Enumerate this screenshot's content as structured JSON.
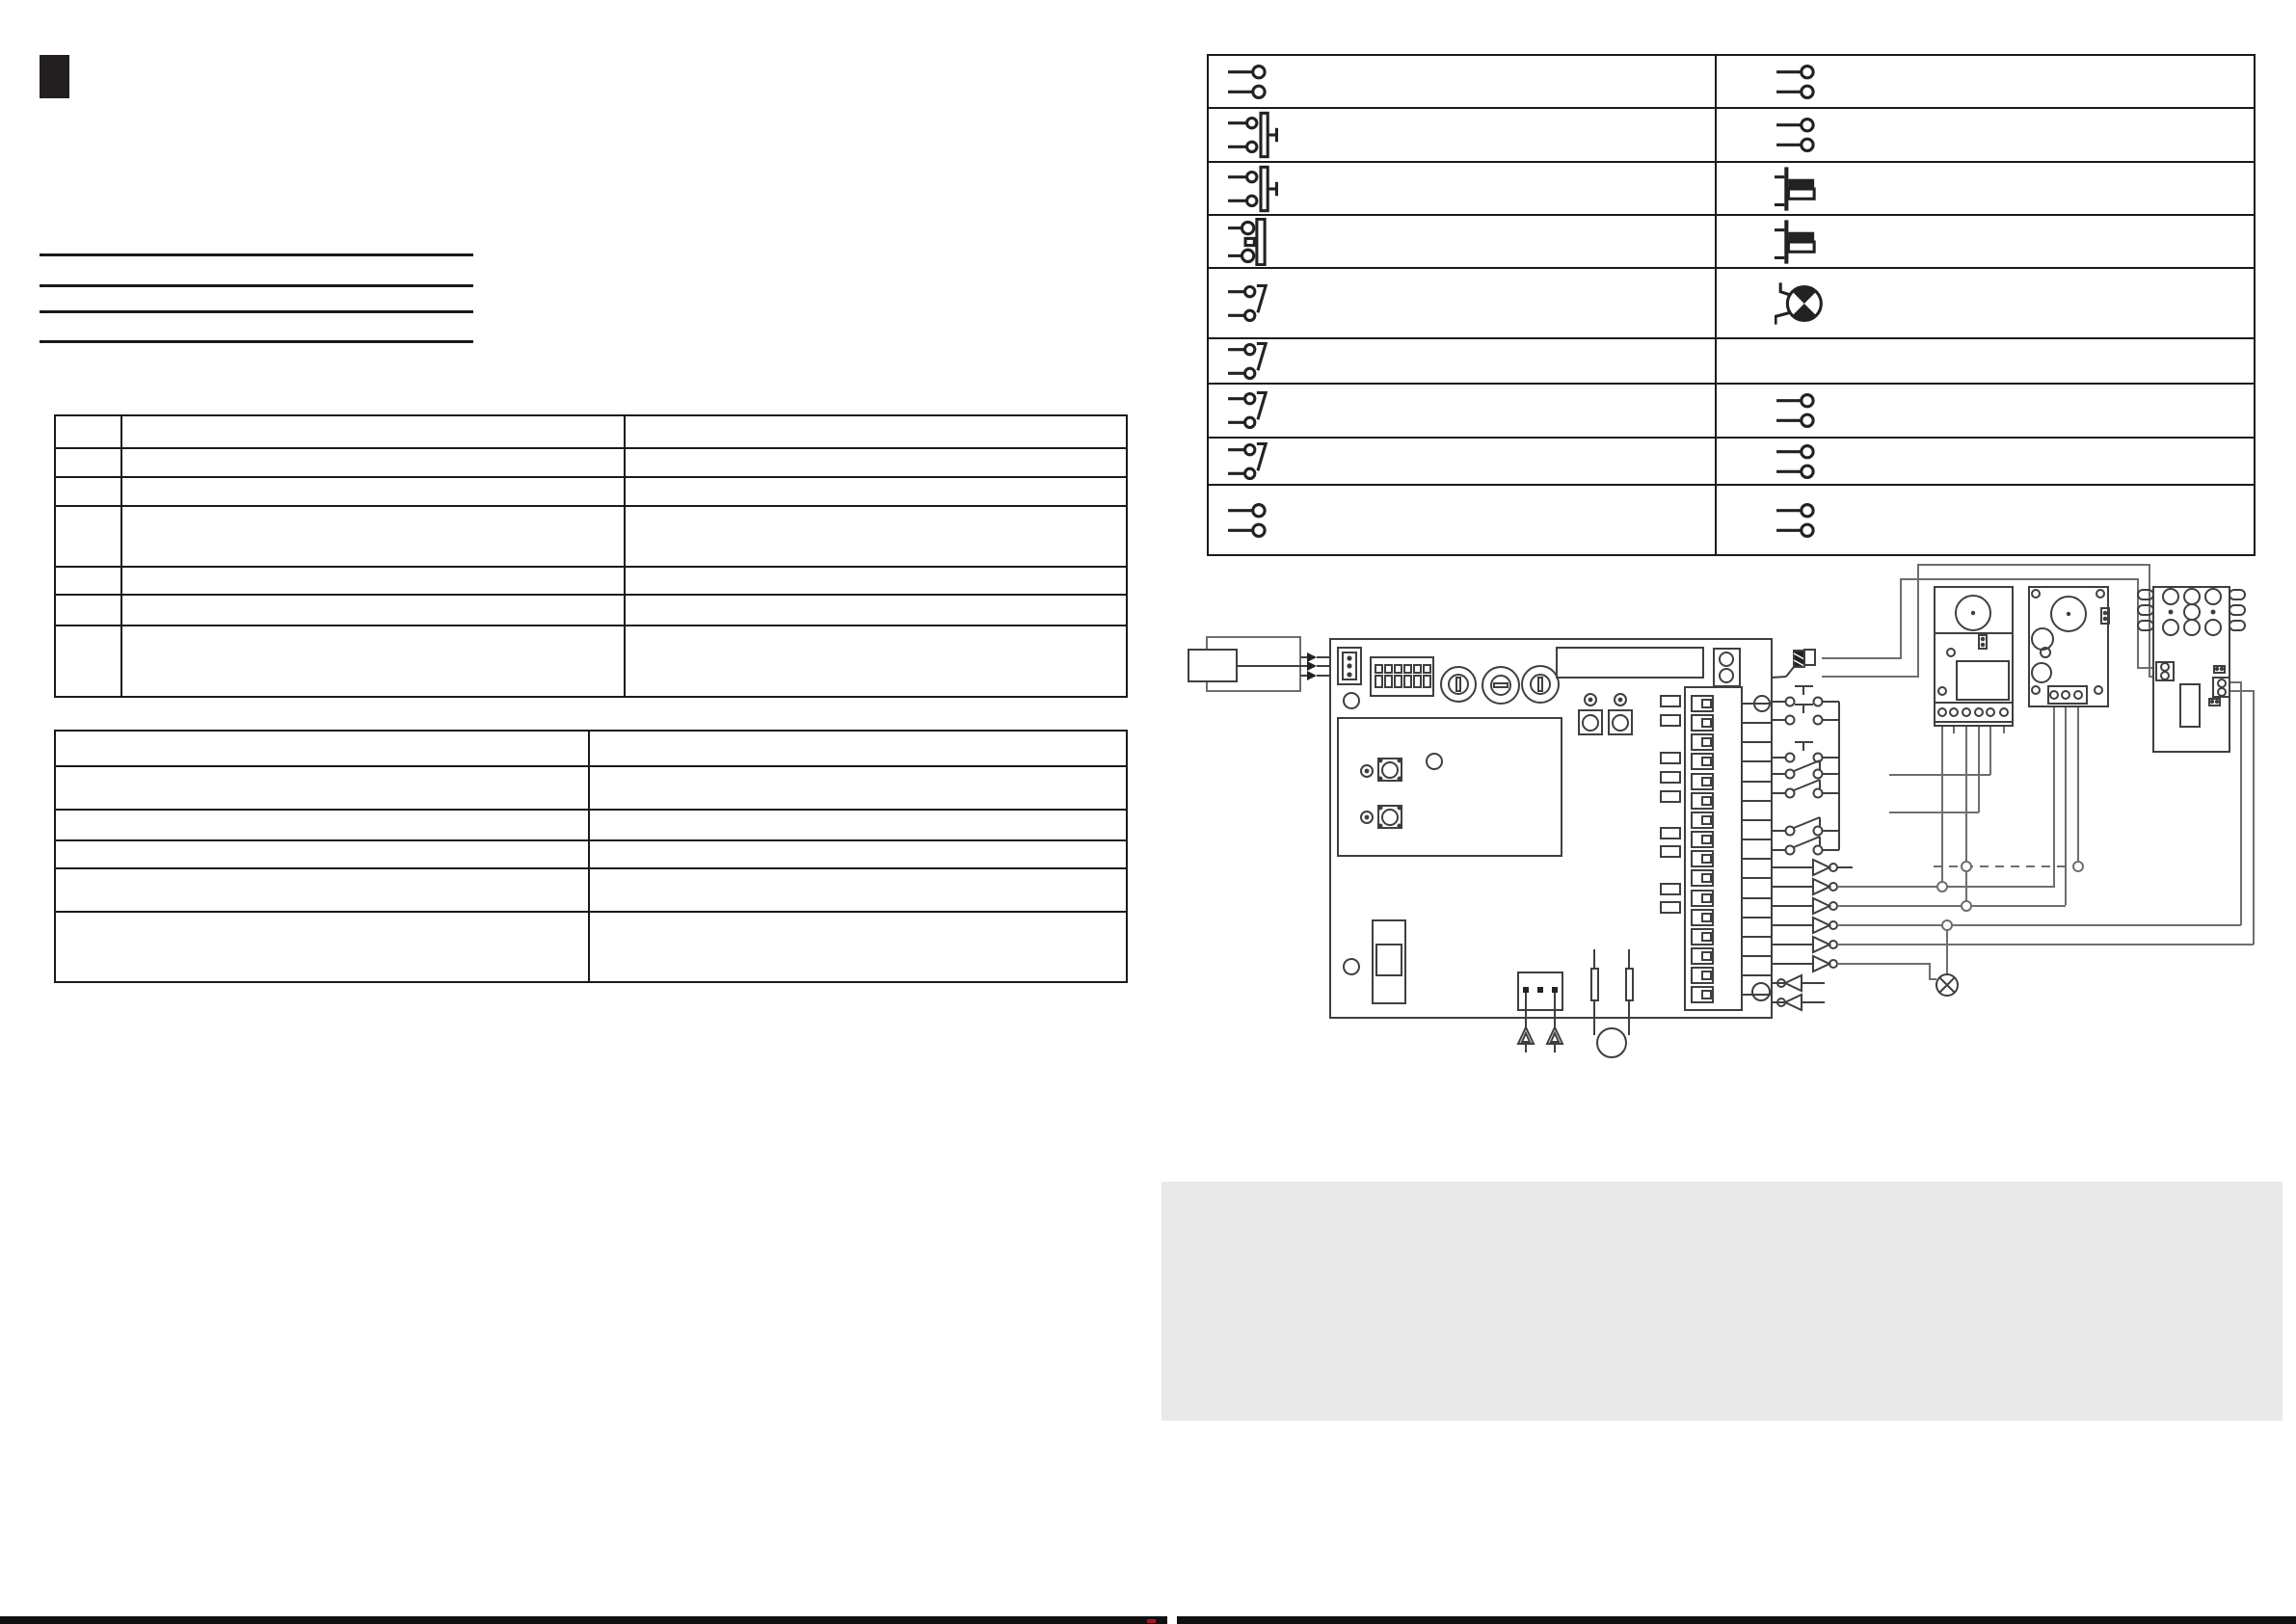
{
  "page": {
    "kind": "scanned manual page (blank translation template, no printed text visible)",
    "background": "#ffffff",
    "visible_text": ""
  },
  "colors": {
    "table_line": "#1a1a1a",
    "component_stroke": "#3f3f3f",
    "wire": "#6e6e6e",
    "symbol_fill": "#222222",
    "gray_panel": "#e9e9e9",
    "footer_bar": "#111111",
    "section_marker": "#231f20",
    "registration_mark": "#bb1111"
  },
  "section_marker": {
    "icon": "black-square-chapter-marker",
    "text": ""
  },
  "rule_group": {
    "line_count": 4,
    "text": ""
  },
  "spec_table_upper": {
    "rows": 7,
    "columns": 3,
    "cells_text": "",
    "note": "all cells empty"
  },
  "spec_table_lower": {
    "rows": 6,
    "columns": 2,
    "cells_text": "",
    "note": "all cells empty"
  },
  "legend": {
    "title": "",
    "columns": 2,
    "rows": [
      {
        "left_symbol": "contact-pair",
        "right_symbol": "contact-pair"
      },
      {
        "left_symbol": "pushbutton",
        "right_symbol": "contact-pair"
      },
      {
        "left_symbol": "pushbutton",
        "right_symbol": "limit-flag"
      },
      {
        "left_symbol": "keyswitch",
        "right_symbol": "limit-flag"
      },
      {
        "left_symbol": "changeover",
        "right_symbol": "motor"
      },
      {
        "left_symbol": "changeover",
        "right_symbol": "none"
      },
      {
        "left_symbol": "changeover",
        "right_symbol": "contact-pair"
      },
      {
        "left_symbol": "changeover",
        "right_symbol": "contact-pair"
      },
      {
        "left_symbol": "contact-pair",
        "right_symbol": "contact-pair"
      }
    ]
  },
  "wiring_diagram": {
    "components": [
      "antenna-module",
      "antenna-shield-loop",
      "main-control-board",
      "board-3pin-connector",
      "dip-switch-block-6",
      "rotary-pot-1",
      "rotary-pot-2",
      "rotary-pot-3",
      "display-window",
      "2way-connector",
      "status-leds",
      "pcb-buttons",
      "relay-area",
      "relay-button-1",
      "relay-button-2",
      "power-switch",
      "aerial-3pin-connector",
      "fuse-1",
      "fuse-2",
      "buzzer",
      "terminal-strip-16",
      "led-column-9",
      "motor-plug-hatched",
      "pushbutton-contacts-3",
      "switch-contacts-4",
      "output-drivers-6",
      "input-drivers-2",
      "control-unit-a",
      "control-unit-b",
      "terminal-block-3x3",
      "plug-2pin-left",
      "plug-2pin-right",
      "warning-lamp",
      "dashed-link-wire"
    ],
    "terminal_count": 16,
    "led_count": 9,
    "dip_positions": 6,
    "output_triangles": 6,
    "input_triangles": 2,
    "unit_a_terminals": 6,
    "unit_b_terminals": 3
  },
  "gray_panel": {
    "text": ""
  },
  "footer": {
    "bar_segments": 2,
    "text": ""
  }
}
